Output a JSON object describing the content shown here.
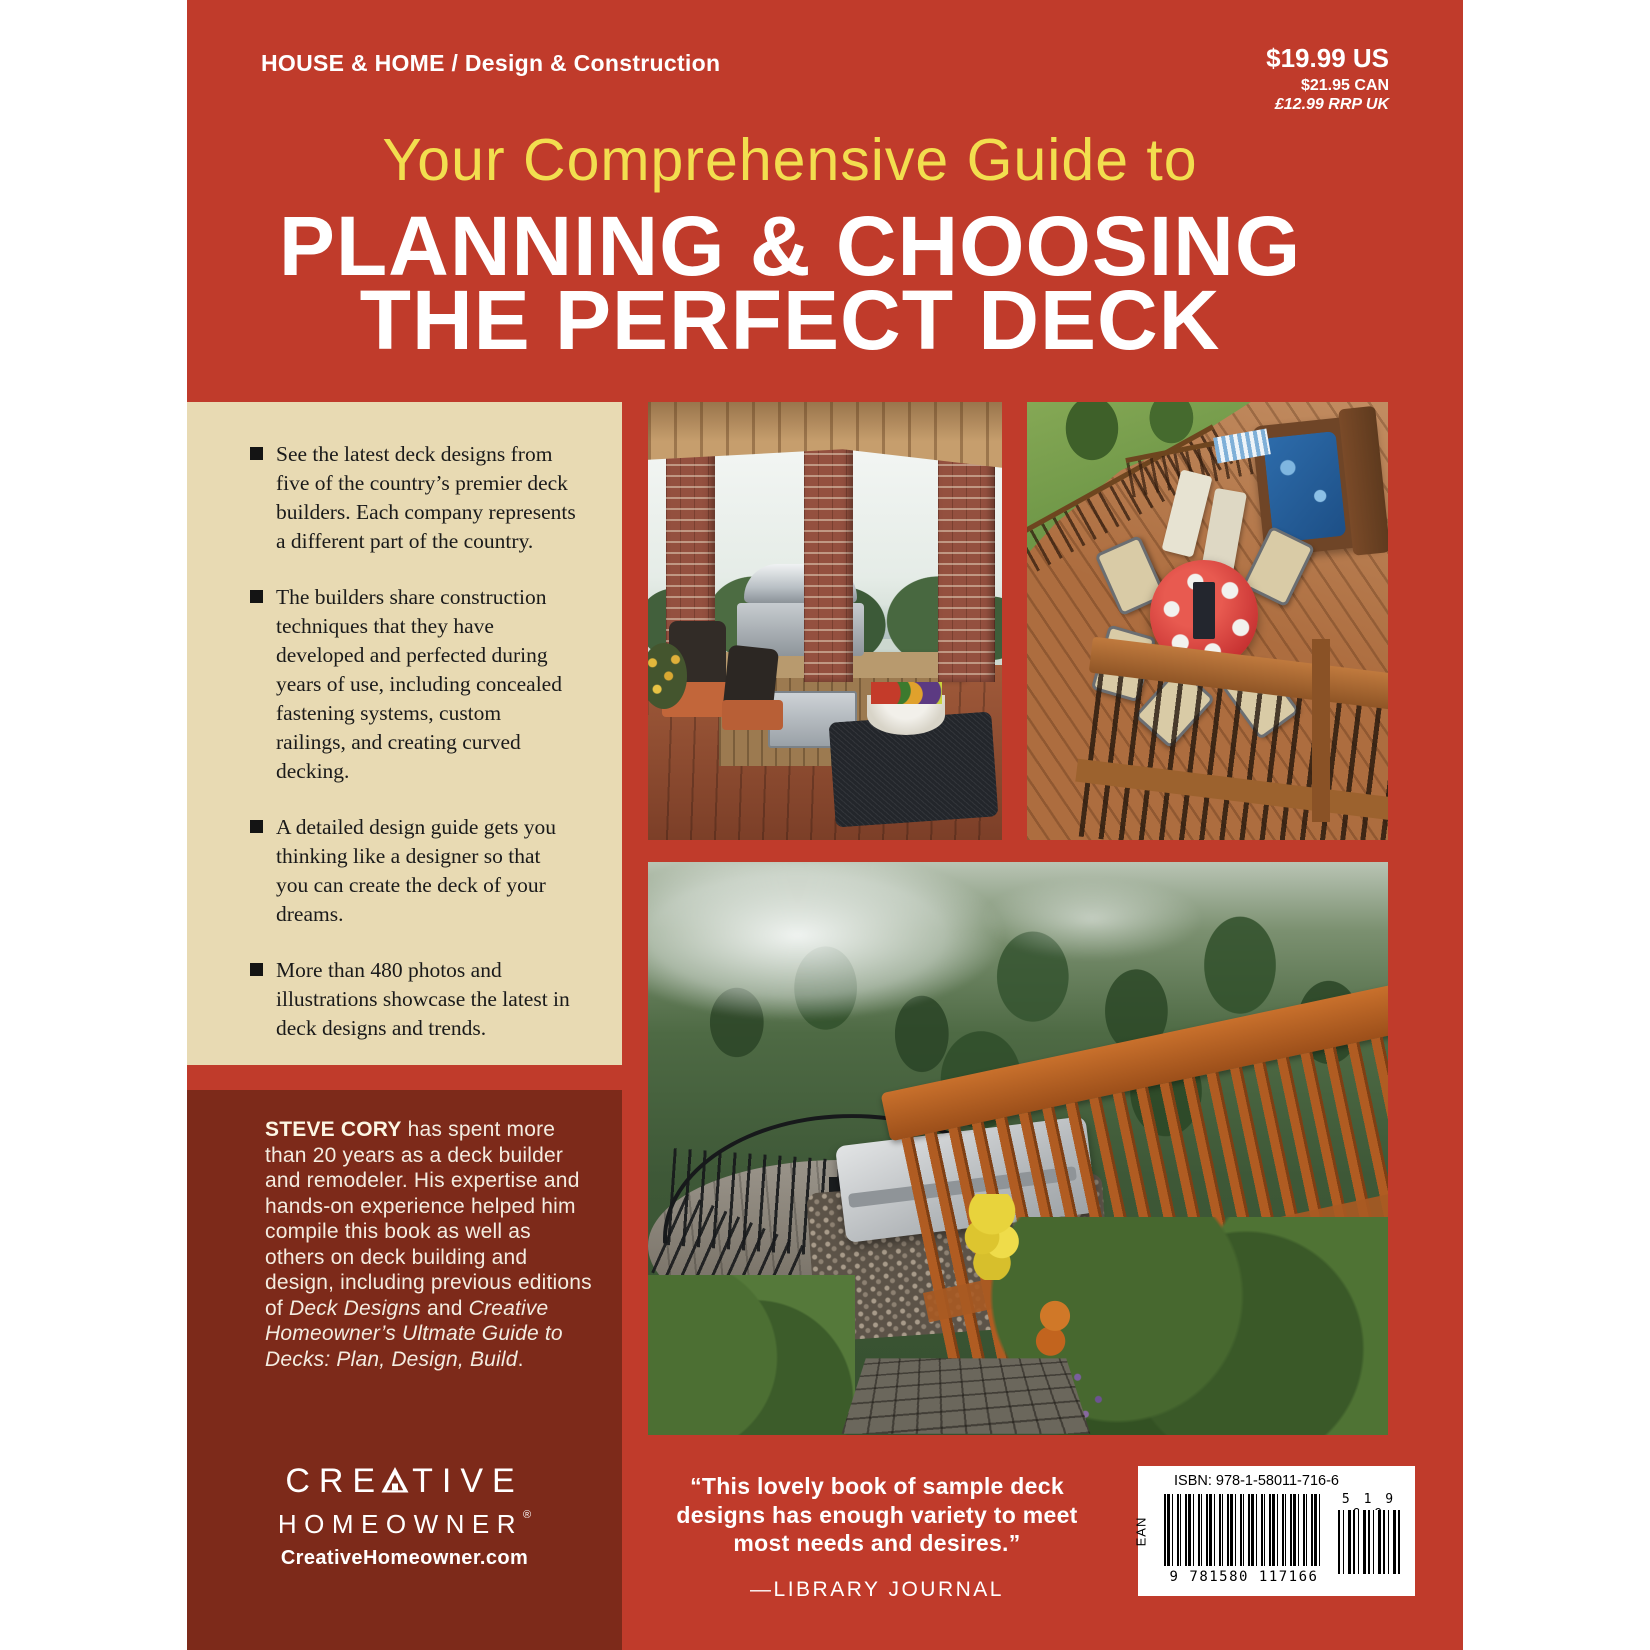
{
  "colors": {
    "cover_red": "#c03b2b",
    "panel_maroon": "#7d2a1a",
    "panel_cream": "#e8dab3",
    "title_yellow": "#f2de4f",
    "text_white": "#ffffff"
  },
  "header": {
    "category": "HOUSE & HOME / Design & Construction",
    "price_us": "$19.99 US",
    "price_can": "$21.95 CAN",
    "price_uk": "£12.99 RRP UK"
  },
  "title": {
    "kicker": "Your Comprehensive Guide to",
    "line1": "PLANNING & CHOOSING",
    "line2": "THE PERFECT DECK"
  },
  "features": [
    "See the latest deck designs from five of the country’s premier deck builders. Each company represents a different part of the country.",
    "The builders share construction techniques that they have developed and perfected during years of use, including concealed fastening systems, custom railings, and creating curved decking.",
    "A detailed design guide gets you thinking like a designer so that you can create the deck of your dreams.",
    "More than 480 photos and illustrations showcase the latest in deck designs and trends."
  ],
  "bio": {
    "name": "STEVE CORY",
    "r1": " has spent more than 20 years as a deck builder and remodeler. His expertise and hands-on experience helped him compile this book as well as others on deck building and design, including previous editions of ",
    "i1": "Deck Designs",
    "r2": " and ",
    "i2": "Creative Homeowner’s Ultmate Guide to Decks: Plan, Design, Build",
    "r3": "."
  },
  "logo": {
    "pre": "CRE",
    "post": "TIVE",
    "line2": "HOMEOWNER",
    "reg": "®",
    "url": "CreativeHomeowner.com"
  },
  "quote": {
    "text": "“This lovely book of sample deck designs has enough variety to meet most needs and desires.”",
    "attribution": "—LIBRARY JOURNAL"
  },
  "barcode": {
    "isbn": "ISBN: 978-1-58011-716-6",
    "ean": "EAN",
    "digits": "9 781580 117166",
    "supplement": "5 1 9 9 9"
  }
}
